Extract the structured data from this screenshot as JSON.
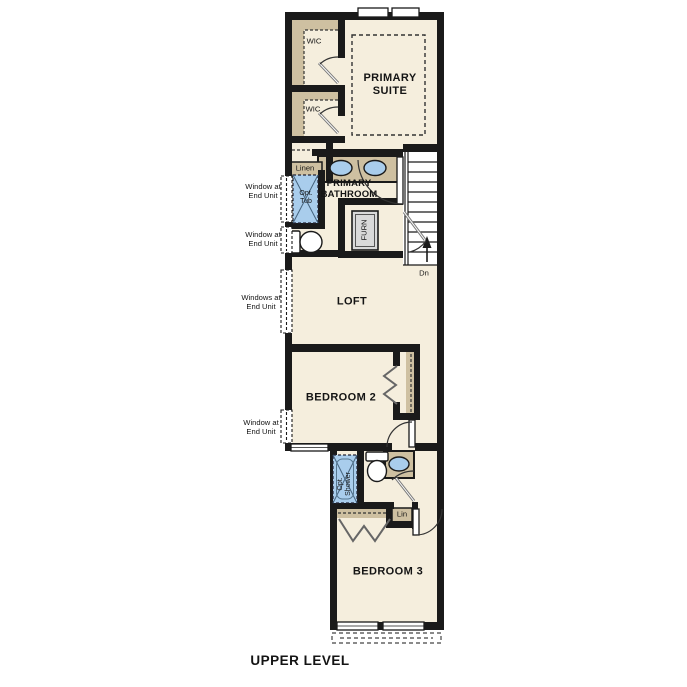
{
  "title": "UPPER LEVEL",
  "rooms": {
    "primary_suite": "PRIMARY\nSUITE",
    "wic_1": "WIC",
    "wic_2": "WIC",
    "primary_bathroom": "PRIMARY\nBATHROOM",
    "loft": "LOFT",
    "bedroom_2": "BEDROOM 2",
    "bedroom_3": "BEDROOM 3"
  },
  "closets": {
    "linen_upper": "Linen",
    "linen_lower": "Lin"
  },
  "fixtures": {
    "optional_tub": "Opt.\nTub",
    "optional_shower": "Opt.\nShower",
    "furnace": "FURN"
  },
  "stairs": {
    "down_label": "Dn"
  },
  "annotations": {
    "window_tub": "Window at\nEnd Unit",
    "window_toilet": "Window at\nEnd Unit",
    "windows_loft": "Windows at\nEnd Unit",
    "window_bedroom2": "Window at\nEnd Unit"
  },
  "colors": {
    "floor": "#f5eedd",
    "wall": "#1a1a1a",
    "closet_shading": "#cec0a1",
    "fixture_blue": "#a9cdec",
    "furnace_gray": "#d9d9d9",
    "background": "#ffffff"
  }
}
